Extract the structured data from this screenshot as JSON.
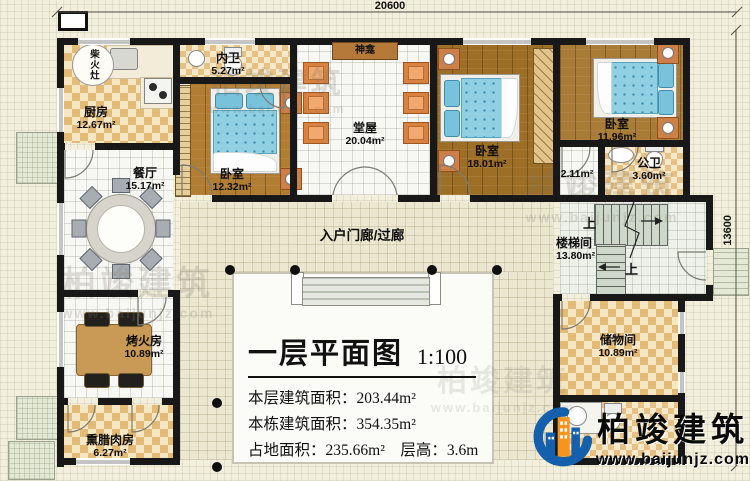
{
  "dimensions": {
    "top": "20600",
    "right": "13600"
  },
  "rooms": {
    "kitchen": {
      "name": "厨房",
      "area": "12.67m²"
    },
    "stove": {
      "name": "柴火灶"
    },
    "inner_bath": {
      "name": "内卫",
      "area": "5.27m²"
    },
    "shrine": {
      "name": "神龛"
    },
    "hall": {
      "name": "堂屋",
      "area": "20.04m²"
    },
    "bedroom_left": {
      "name": "卧室",
      "area": "12.32m²"
    },
    "bedroom_mid": {
      "name": "卧室",
      "area": "18.01m²"
    },
    "bedroom_right": {
      "name": "卧室",
      "area": "11.96m²"
    },
    "closet": {
      "area": "2.11m²"
    },
    "public_bath": {
      "name": "公卫",
      "area": "3.60m²"
    },
    "dining": {
      "name": "餐厅",
      "area": "15.17m²"
    },
    "porch": {
      "name": "入户门廊/过廊"
    },
    "stair_hall": {
      "name": "楼梯间",
      "area": "13.80m²"
    },
    "fire_room": {
      "name": "烤火房",
      "area": "10.89m²"
    },
    "smoke_room": {
      "name": "熏腊肉房",
      "area": "6.27m²"
    },
    "storage": {
      "name": "储物间",
      "area": "10.89m²"
    }
  },
  "stairs": {
    "up": "上"
  },
  "title_block": {
    "title": "一层平面图",
    "scale": "1:100",
    "rows": [
      {
        "label": "本层建筑面积：",
        "value": "203.44m²"
      },
      {
        "label": "本栋建筑面积：",
        "value": "354.35m²"
      },
      {
        "label": "占地面积：",
        "value": "235.66m²",
        "label2": "　层高：",
        "value2": "3.6m"
      }
    ]
  },
  "brand": {
    "name": "柏竣建筑",
    "website": "www.baijunjz.com"
  },
  "colors": {
    "wall": "#181818",
    "accent_blue": "#1560ad",
    "accent_orange": "#f7941d"
  }
}
